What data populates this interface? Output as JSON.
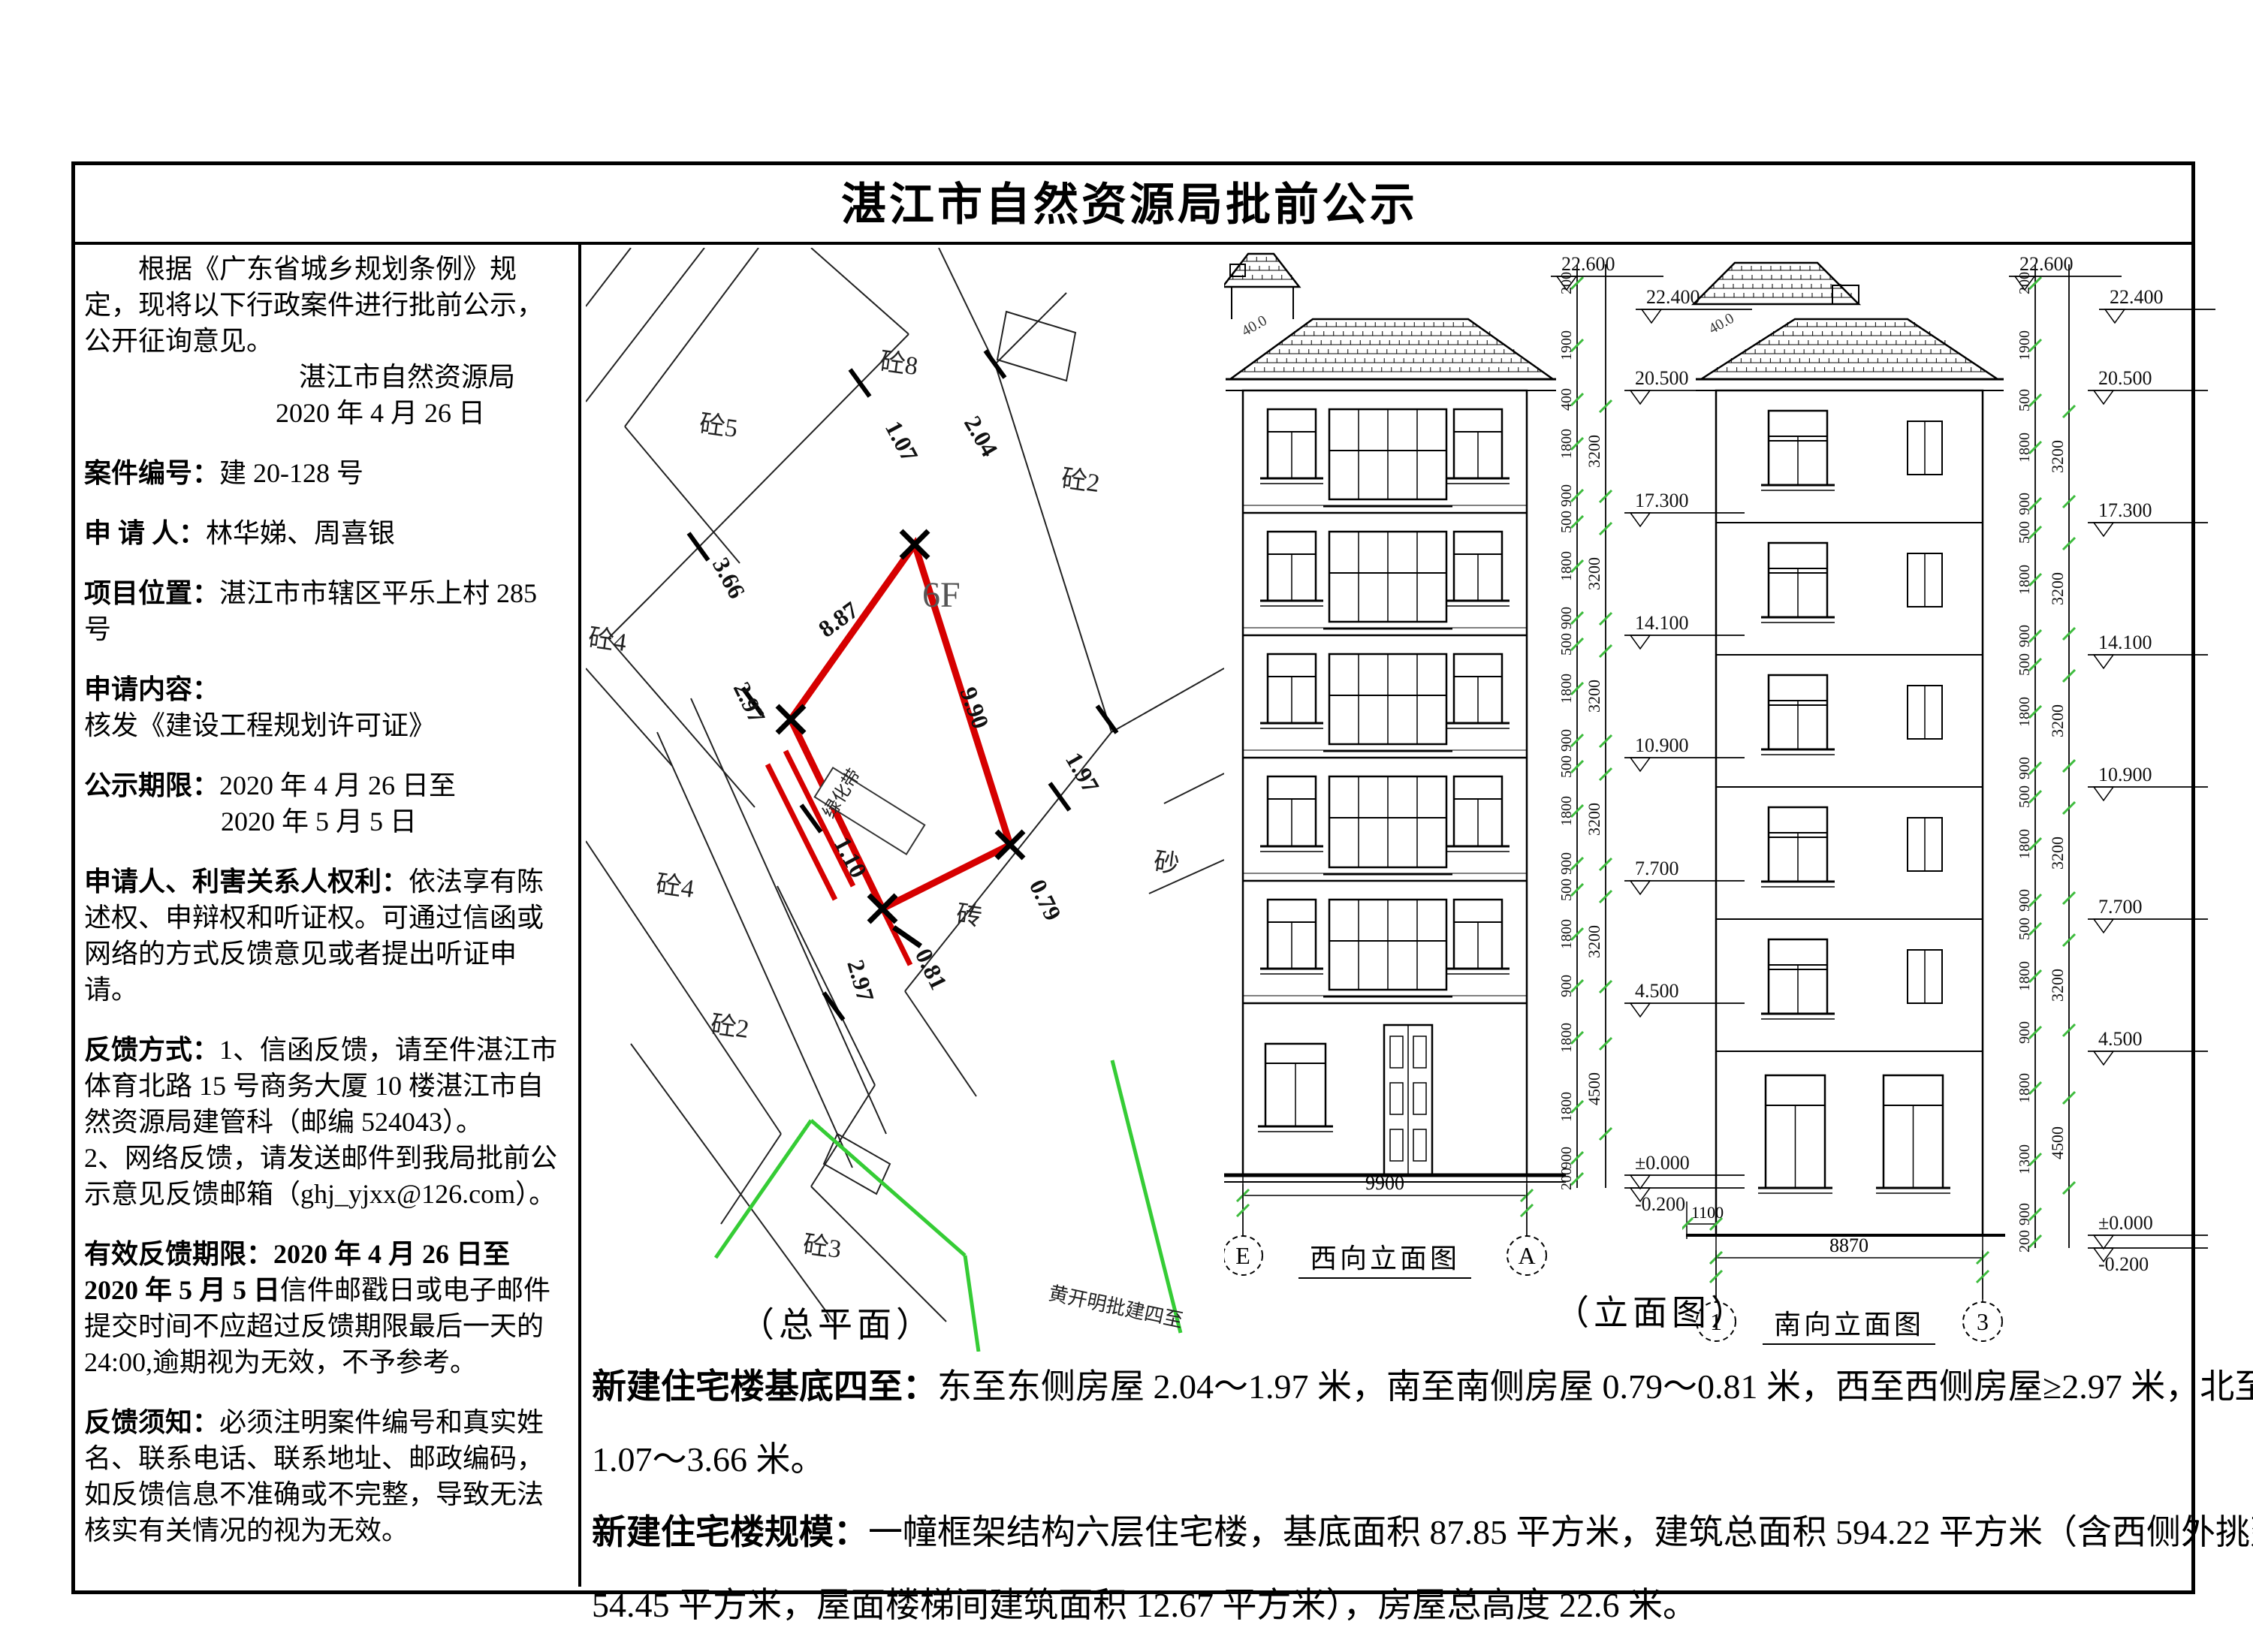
{
  "title": "湛江市自然资源局批前公示",
  "notice": {
    "intro": "根据《广东省城乡规划条例》规定，现将以下行政案件进行批前公示，公开征询意见。",
    "agency": "湛江市自然资源局",
    "date": "2020 年 4 月 26 日",
    "case_label": "案件编号：",
    "case_value": "建 20-128 号",
    "applicant_label": "申 请 人：",
    "applicant_value": "林华娣、周喜银",
    "location_label": "项目位置：",
    "location_value": "湛江市市辖区平乐上村 285 号",
    "content_label": "申请内容：",
    "content_value": "核发《建设工程规划许可证》",
    "period_label": "公示期限：",
    "period_value1": "2020 年 4 月 26 日至",
    "period_value2": "2020 年 5 月 5 日",
    "rights_label": "申请人、利害关系人权利：",
    "rights_text": "依法享有陈述权、申辩权和听证权。可通过信函或网络的方式反馈意见或者提出听证申请。",
    "feedback_label": "反馈方式：",
    "feedback_text1": "1、信函反馈，请至件湛江市体育北路 15 号商务大厦 10 楼湛江市自然资源局建管科（邮编 524043）。",
    "feedback_text2": "2、网络反馈，请发送邮件到我局批前公示意见反馈邮箱（ghj_yjxx@126.com）。",
    "valid_label": "有效反馈期限：",
    "valid_bold": "2020 年 4 月 26 日至 2020 年 5 月 5 日",
    "valid_text": "信件邮戳日或电子邮件提交时间不应超过反馈期限最后一天的 24:00,逾期视为无效，不予参考。",
    "note_label": "反馈须知：",
    "note_text": "必须注明案件编号和真实姓名、联系电话、联系地址、邮政编码，如反馈信息不准确或不完整，导致无法核实有关情况的视为无效。"
  },
  "site_plan": {
    "caption": "（总平面）",
    "plot_floors": "6F",
    "labels": [
      "砼5",
      "砼8",
      "砼2",
      "砼4",
      "砼4",
      "砼2",
      "砼3",
      "砖",
      "砂"
    ],
    "dims": {
      "d107": "1.07",
      "d204": "2.04",
      "d366": "3.66",
      "d297": "2.97",
      "d887": "8.87",
      "d990": "9.90",
      "d110": "1.10",
      "d197": "1.97",
      "d079": "0.79",
      "d081": "0.81",
      "d297b": "2.97"
    },
    "green_label": "黄开明批建四至",
    "inner_label": "绿化带",
    "red_color": "#d60000",
    "green_color": "#35cc35"
  },
  "elevations": {
    "caption": "（立面图）",
    "west": {
      "caption": "西向立面图",
      "width_dim": "9900",
      "grid_left": "E",
      "grid_right": "A",
      "roof_note": "40.0",
      "flags": [
        "22.600",
        "22.400",
        "20.500",
        "17.300",
        "14.100",
        "10.900",
        "7.700",
        "4.500",
        "±0.000",
        "-0.200"
      ],
      "coarse": [
        "3200",
        "3200",
        "3200",
        "3200",
        "3200",
        "4500"
      ],
      "fine": [
        "200",
        "1900",
        "400",
        "1800",
        "900",
        "500",
        "1800",
        "900",
        "500",
        "1800",
        "900",
        "500",
        "1800",
        "900",
        "500",
        "1800",
        "900",
        "1800",
        "1800",
        "900",
        "200"
      ]
    },
    "south": {
      "caption": "南向立面图",
      "width_dim": "8870",
      "offset_dim": "1100",
      "grid_left": "1",
      "grid_right": "3",
      "roof_note": "40.0",
      "flags": [
        "22.600",
        "22.400",
        "20.500",
        "17.300",
        "14.100",
        "10.900",
        "7.700",
        "4.500",
        "±0.000",
        "-0.200"
      ],
      "coarse": [
        "3200",
        "3200",
        "3200",
        "3200",
        "3200",
        "4500"
      ],
      "fine": [
        "200",
        "1900",
        "500",
        "1800",
        "900",
        "500",
        "1800",
        "900",
        "500",
        "1800",
        "900",
        "500",
        "1800",
        "900",
        "500",
        "1800",
        "900",
        "1800",
        "1300",
        "900",
        "200"
      ]
    }
  },
  "footer": {
    "p1_label": "新建住宅楼基底四至：",
    "p1_line1": "东至东侧房屋 2.04～1.97 米，南至南侧房屋 0.79～0.81 米，西至西侧房屋≥2.97 米，北至北侧房屋",
    "p1_line2": "1.07～3.66 米。",
    "p2_label": "新建住宅楼规模：",
    "p2_line1": "一幢框架结构六层住宅楼，基底面积 87.85 平方米，建筑总面积 594.22 平方米（含西侧外挑建筑面积",
    "p2_line2": "54.45 平方米，屋面楼梯间建筑面积 12.67 平方米），房屋总高度 22.6 米。"
  }
}
